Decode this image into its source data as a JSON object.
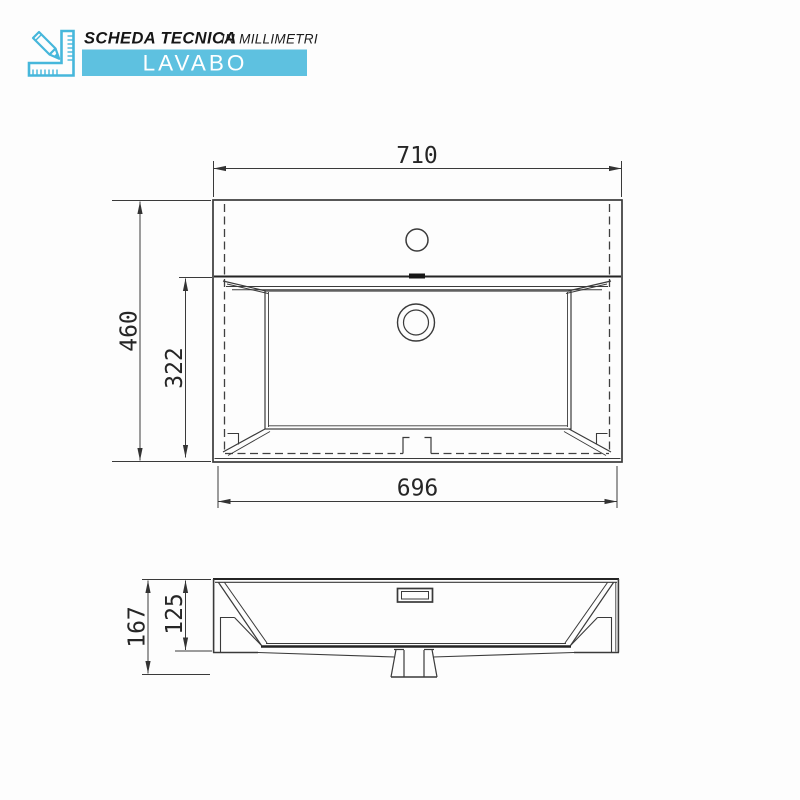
{
  "header": {
    "title": "SCHEDA TECNICA",
    "subtitle": "IN MILLIMETRI",
    "banner_label": "LAVABO"
  },
  "colors": {
    "banner_blue": "#5ec1e0",
    "icon_blue": "#46b7db",
    "line_dark": "#3a3a3a"
  },
  "dimensions_mm": {
    "top_view": {
      "overall_width": "710",
      "overall_depth": "460",
      "basin_depth": "322",
      "bottom_width": "696"
    },
    "front_view": {
      "overall_height": "167",
      "basin_inner_height": "125"
    }
  }
}
